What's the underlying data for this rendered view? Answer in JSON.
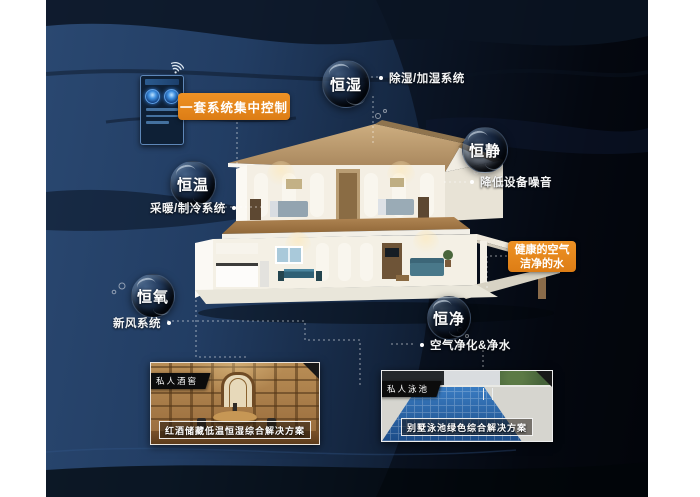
{
  "control": {
    "box_label": "一套系统集中控制",
    "panel_icon": "smart-control-panel-icon",
    "wifi_icon": "wifi-icon"
  },
  "highlight": {
    "line1": "健康的空气",
    "line2": "洁净的水"
  },
  "bubbles": [
    {
      "label": "恒湿",
      "note": "除湿/加湿系统"
    },
    {
      "label": "恒静",
      "note": "降低设备噪音"
    },
    {
      "label": "恒温",
      "note": "采暖/制冷系统"
    },
    {
      "label": "恒氧",
      "note": "新风系统"
    },
    {
      "label": "恒净",
      "note": "空气净化&净水"
    }
  ],
  "cards": [
    {
      "tag": "私人酒窖",
      "caption": "红酒储藏低温恒湿综合解决方案"
    },
    {
      "tag": "私人泳池",
      "caption": "别墅泳池绿色综合解决方案"
    }
  ],
  "colors": {
    "accent_orange": "#e5861d",
    "bg_navy": "#223d63",
    "bg_dark": "#03060b"
  }
}
